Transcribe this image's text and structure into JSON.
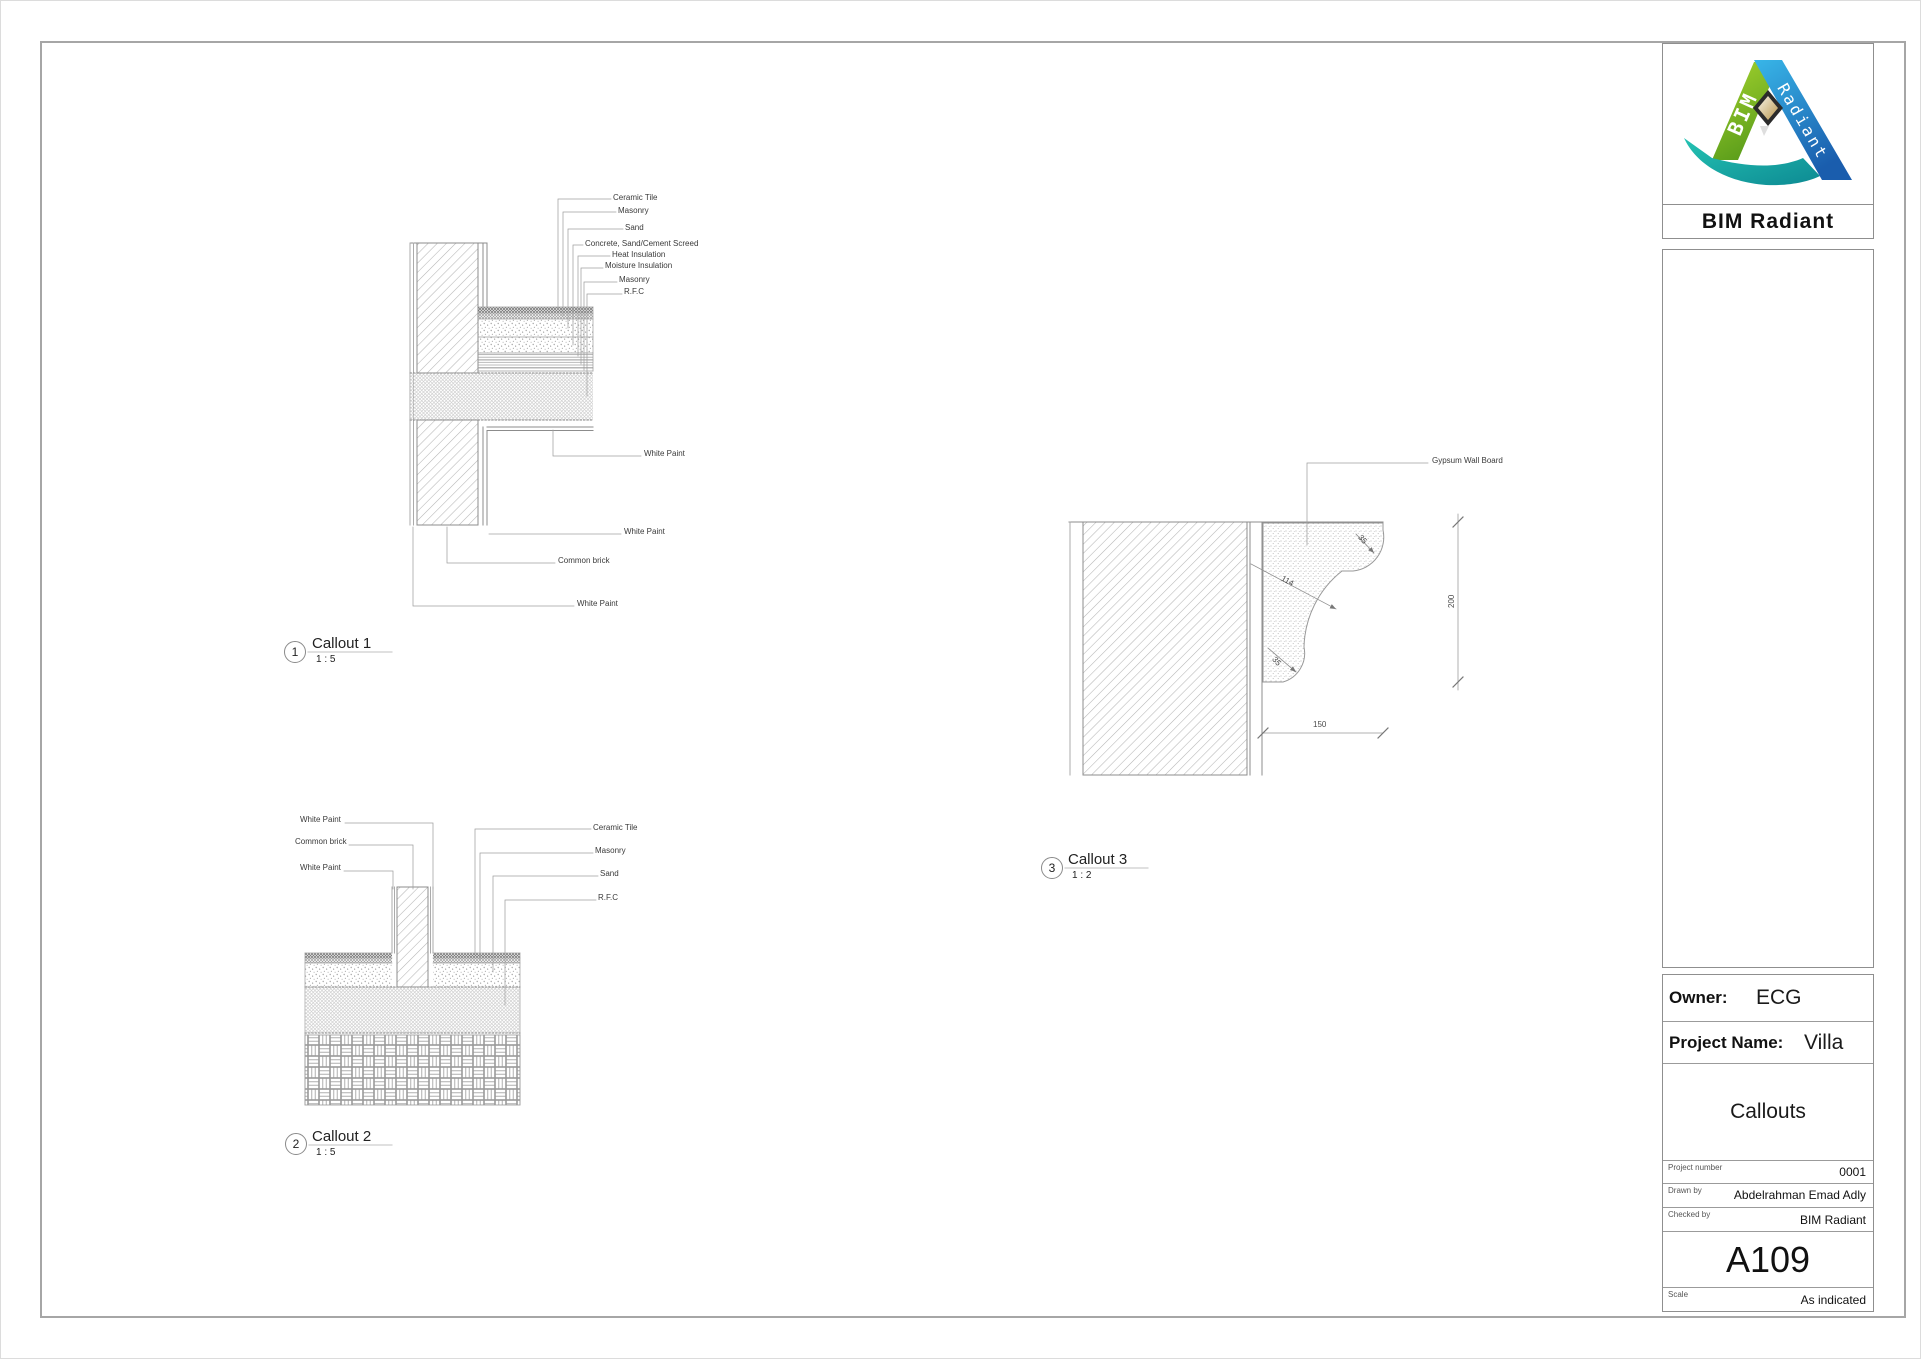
{
  "sheet": {
    "border_color": "#a6a6a6"
  },
  "title_block": {
    "logo": {
      "ribbon_left_text": "BIM",
      "ribbon_right_text": "Radiant",
      "caption": "BIM Radiant",
      "green": "#7ab929",
      "blue": "#1b6bb5",
      "teal": "#10a39b"
    },
    "owner_label": "Owner:",
    "owner_value": "ECG",
    "project_name_label": "Project Name:",
    "project_name_value": "Villa",
    "sheet_title": "Callouts",
    "project_number_label": "Project number",
    "project_number_value": "0001",
    "drawn_by_label": "Drawn by",
    "drawn_by_value": "Abdelrahman Emad Adly",
    "checked_by_label": "Checked by",
    "checked_by_value": "BIM Radiant",
    "sheet_number": "A109",
    "scale_label": "Scale",
    "scale_value": "As indicated"
  },
  "callout1": {
    "number": "1",
    "title": "Callout 1",
    "scale": "1 : 5",
    "labels_right": [
      "Ceramic Tile",
      "Masonry",
      "Sand",
      "Concrete, Sand/Cement Screed",
      "Heat Insulation",
      "Moisture Insulation",
      "Masonry",
      "R.F.C"
    ],
    "label_white_paint_a": "White Paint",
    "label_white_paint_b": "White Paint",
    "label_common_brick": "Common brick",
    "label_white_paint_c": "White Paint"
  },
  "callout2": {
    "number": "2",
    "title": "Callout 2",
    "scale": "1 : 5",
    "labels_left": [
      "White Paint",
      "Common brick",
      "White Paint"
    ],
    "labels_right": [
      "Ceramic Tile",
      "Masonry",
      "Sand",
      "R.F.C"
    ]
  },
  "callout3": {
    "number": "3",
    "title": "Callout 3",
    "scale": "1 : 2",
    "label_gypsum": "Gypsum Wall Board",
    "dims": {
      "radius_top": "35",
      "diagonal": "114",
      "radius_bottom": "35",
      "height": "200",
      "width": "150"
    }
  }
}
